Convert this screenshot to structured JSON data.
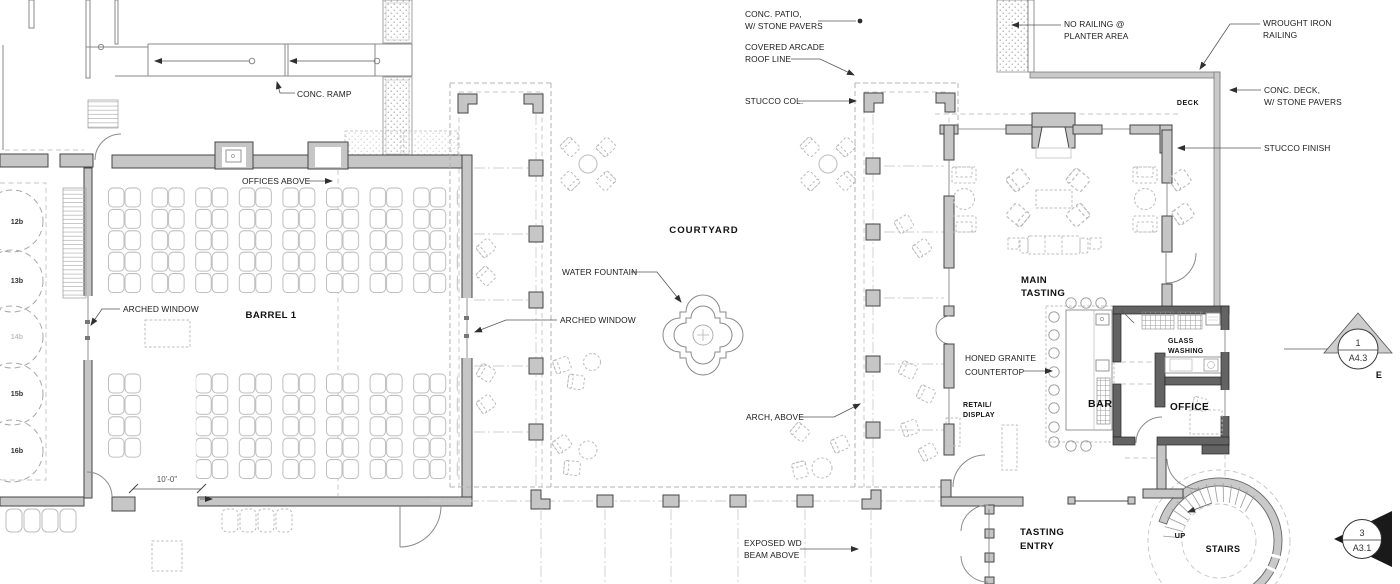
{
  "drawing": {
    "rooms": {
      "barrel1": "BARREL 1",
      "courtyard": "COURTYARD",
      "main_tasting_1": "MAIN",
      "main_tasting_2": "TASTING",
      "bar": "BAR",
      "office": "OFFICE",
      "glass_washing_1": "GLASS",
      "glass_washing_2": "WASHING",
      "retail_1": "RETAIL/",
      "retail_2": "DISPLAY",
      "tasting_entry_1": "TASTING",
      "tasting_entry_2": "ENTRY",
      "deck": "DECK",
      "stairs": "STAIRS",
      "up": "UP"
    },
    "annotations": {
      "conc_patio_1": "CONC. PATIO,",
      "conc_patio_2": "W/ STONE PAVERS",
      "covered_arcade_1": "COVERED ARCADE",
      "covered_arcade_2": "ROOF LINE",
      "stucco_col": "STUCCO COL.",
      "no_railing_1": "NO RAILING @",
      "no_railing_2": "PLANTER AREA",
      "wrought_iron_1": "WROUGHT IRON",
      "wrought_iron_2": "RAILING",
      "conc_deck_1": "CONC. DECK,",
      "conc_deck_2": "W/ STONE PAVERS",
      "stucco_finish": "STUCCO FINISH",
      "conc_ramp": "CONC. RAMP",
      "offices_above": "OFFICES ABOVE",
      "arched_window_left": "ARCHED WINDOW",
      "arched_window_right": "ARCHED WINDOW",
      "water_fountain": "WATER FOUNTAIN",
      "arch_above": "ARCH, ABOVE",
      "honed_granite_1": "HONED GRANITE",
      "honed_granite_2": "COUNTERTOP",
      "exposed_wd_1": "EXPOSED WD",
      "exposed_wd_2": "BEAM ABOVE",
      "dim_10_0": "10'-0\""
    },
    "tanks": {
      "t12": "12b",
      "t13": "13b",
      "t14": "14b",
      "t15": "15b",
      "t16": "16b"
    },
    "markers": {
      "detail": {
        "num": "1",
        "sheet": "A4.3",
        "dir": "E"
      },
      "section": {
        "num": "3",
        "sheet": "A3.1"
      }
    },
    "colors": {
      "wall": "#c6c6c6",
      "wall_dark": "#636363",
      "outline": "#454545",
      "dashed": "#b3b3b3",
      "text": "#1c1c1c"
    }
  }
}
